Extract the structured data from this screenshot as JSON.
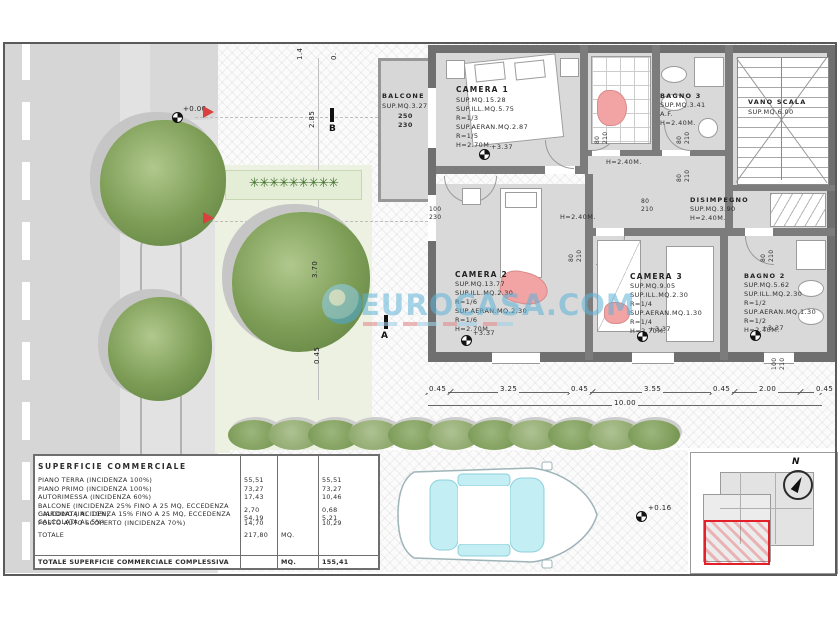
{
  "watermark": {
    "text": "EUROCASA.COM"
  },
  "site": {
    "level_zero": "+0.00",
    "dim_285": "2.85",
    "dim_370": "3.70",
    "dim_045": "0.45",
    "dim_top_a": "1.4",
    "dim_top_b": "0.",
    "section_b": "B",
    "section_a": "A",
    "plants_glyphs": "✳✳✳✳✳✳✳✳✳"
  },
  "plan": {
    "balcone": {
      "name": "BALCONE",
      "area": "SUP.MQ.3.27",
      "window": "250\n230"
    },
    "camera1": {
      "name": "CAMERA 1",
      "lines": "SUP.MQ.15.28\nSUP.ILL.MQ.5.75\nR=1/3\nSUP.AERAN.MQ.2.87\nR=1/5\nH=2.70M.",
      "level": "+3.37"
    },
    "bagno3": {
      "name": "BAGNO 3",
      "lines": "SUP.MQ.3.41\nA.F.\nH=2.40M."
    },
    "vano_scala": {
      "name": "VANO SCALA",
      "area": "SUP.MQ.6.00"
    },
    "disimpegno": {
      "name": "DISIMPEGNO",
      "lines": "SUP.MQ.3.90\nH=2.40M."
    },
    "hall_height_1": "H=2.40M.",
    "hall_height_2": "H=2.40M.",
    "camera2": {
      "name": "CAMERA 2",
      "lines": "SUP.MQ.13.77\nSUP.ILL.MQ.2.30\nR=1/6\nSUP.AERAN.MQ.2.30\nR=1/6\nH=2.70M.",
      "level": "+3.37"
    },
    "camera3": {
      "name": "CAMERA 3",
      "lines": "SUP.MQ.9.05\nSUP.ILL.MQ.2.30\nR=1/4\nSUP.AERAN.MQ.1.30\nR=1/4\nH=2.70M.",
      "level": "+3.37"
    },
    "bagno2": {
      "name": "BAGNO 2",
      "lines": "SUP.MQ.5.62\nSUP.ILL.MQ.2.30\nR=1/2\nSUP.AERAN.MQ.1.30\nR=1/2\nH=2.40M.",
      "level": "+3.37"
    },
    "doors": [
      "80\n210",
      "80\n210",
      "80\n210",
      "80\n210",
      "80\n210",
      "80\n210",
      "100\n230",
      "100\n210"
    ]
  },
  "dims": {
    "segments": [
      "0.45",
      "3.25",
      "0.45",
      "3.55",
      "0.45",
      "2.00",
      "0.45"
    ],
    "total": "10.00"
  },
  "parking": {
    "level": "+0.16"
  },
  "keyplan": {
    "north": "N"
  },
  "table": {
    "title": "SUPERFICIE COMMERCIALE",
    "rows": [
      {
        "desc": "PIANO TERRA (INCIDENZA 100%)",
        "v1": "55,51",
        "unit": "",
        "v2": "55,51"
      },
      {
        "desc": "PIANO PRIMO (INCIDENZA 100%)",
        "v1": "73,27",
        "unit": "",
        "v2": "73,27"
      },
      {
        "desc": "AUTORIMESSA (INCIDENZA 60%)",
        "v1": "17,43",
        "unit": "",
        "v2": "10,46"
      },
      {
        "desc": "BALCONE (INCIDENZA 25% FINO A 25 MQ, ECCEDENZA CALCOLATA AL 10%)",
        "v1": "2,70",
        "unit": "",
        "v2": "0,68"
      },
      {
        "desc": "GIARDINO (INCIDENZA 15% FINO A 25 MQ, ECCEDENZA CALCOLATA AL 5%)",
        "v1": "54,19",
        "unit": "",
        "v2": "5,21"
      },
      {
        "desc": "POSTO AUTO SCOPERTO (INCIDENZA 70%)",
        "v1": "14,70",
        "unit": "",
        "v2": "10,29"
      }
    ],
    "total_label": "TOTALE",
    "total_value": "217,80",
    "total_unit": "MQ.",
    "footer_label": "TOTALE SUPERFICIE COMMERCIALE COMPLESSIVA",
    "footer_unit": "MQ.",
    "footer_value": "155,41"
  }
}
